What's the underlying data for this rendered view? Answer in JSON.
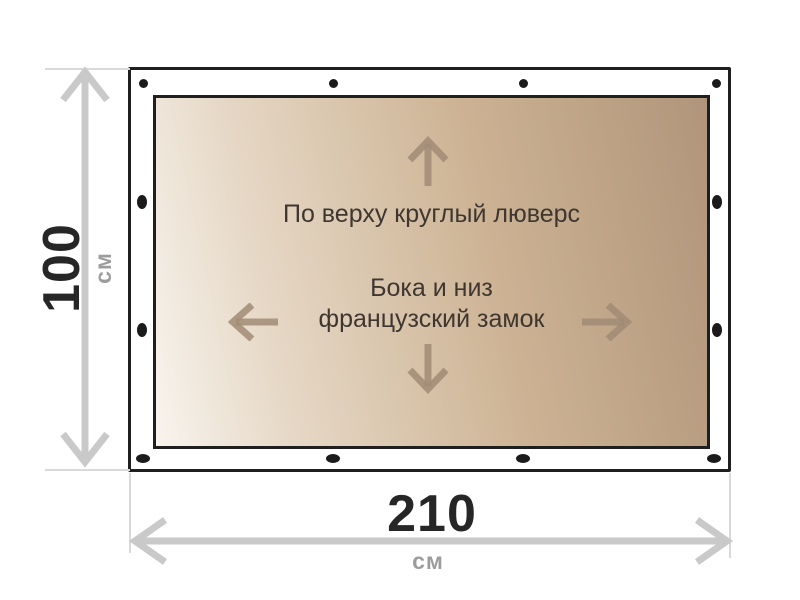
{
  "diagram": {
    "panel_labels": {
      "top": "По верху круглый люверс",
      "middle_line1": "Бока и низ",
      "middle_line2": "французский замок"
    },
    "height_dimension": {
      "value": "100",
      "unit": "см"
    },
    "width_dimension": {
      "value": "210",
      "unit": "см"
    },
    "icons": [
      "up-arrow-icon",
      "down-arrow-icon",
      "left-arrow-icon",
      "right-arrow-icon",
      "grommet-dot"
    ],
    "colors": {
      "frame_border": "#1f1f1f",
      "grommet": "#1b1b1b",
      "panel_gradient_light": "#f8f4ee",
      "panel_gradient_dark": "#b0957a",
      "panel_text": "#3e3731",
      "panel_arrow": "#a18b76",
      "dimension_line": "#c9c9c9",
      "dimension_value_text": "#262626",
      "dimension_unit_text": "#9c9c9c"
    }
  }
}
